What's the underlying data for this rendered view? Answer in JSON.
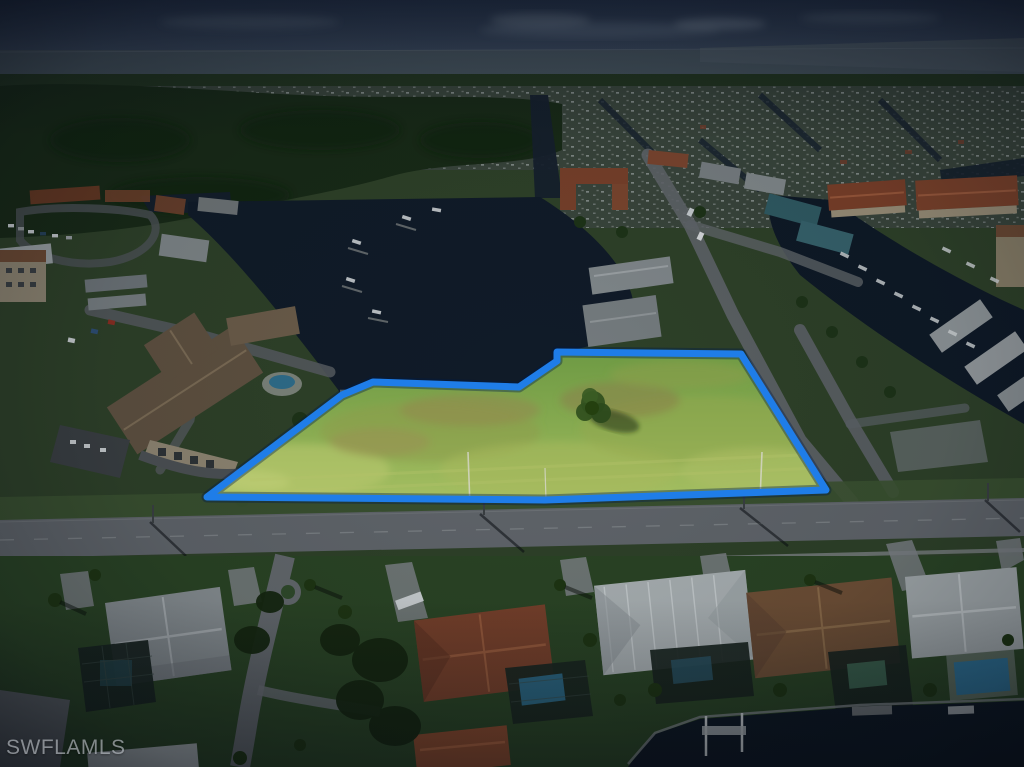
{
  "image": {
    "type": "aerial-photograph",
    "description": "Dusk-darkened aerial photo of a waterfront Florida neighborhood; a vacant grass lot beside a canal is highlighted and outlined in blue"
  },
  "watermark": {
    "text": "SWFLAMLS"
  },
  "annotation": {
    "boundary_color": "#1f7de8",
    "boundary_shadow_color": "rgba(0,25,70,0.38)",
    "boundary_points": "207,497 342,395 373,382 519,387 557,361 557,352 741,354 826,490 545,500",
    "lot_fill_top": "#6e9a44",
    "lot_fill_bottom": "#a6bf62"
  },
  "scene": {
    "colors": {
      "sky": "#26344a",
      "horizon_sea": "#46535c",
      "forest": "#182a16",
      "neighborhood_ground": "#2e4128",
      "water": "#101b28",
      "main_road": "#60656a",
      "terracotta_roof": "#7a3f28",
      "grey_roof": "#8a9194",
      "pool_blue": "#2f7296"
    }
  }
}
